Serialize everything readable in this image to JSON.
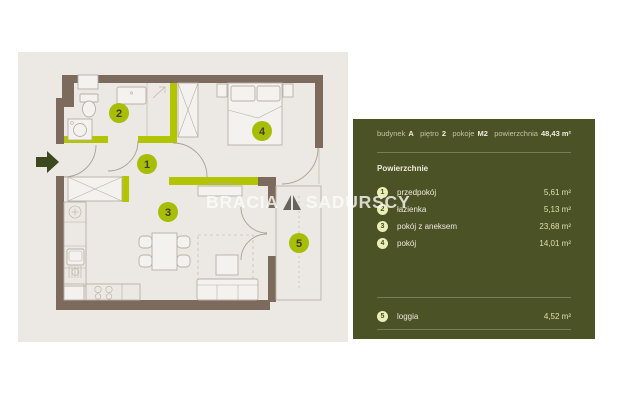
{
  "watermark": {
    "brand_left": "BRACIA",
    "brand_right": "SADURSCY"
  },
  "floorplan": {
    "markers": [
      {
        "num": "1"
      },
      {
        "num": "2"
      },
      {
        "num": "3"
      },
      {
        "num": "4"
      },
      {
        "num": "5"
      }
    ]
  },
  "panel": {
    "header": {
      "items": [
        {
          "label": "budynek",
          "value": "A"
        },
        {
          "label": "piętro",
          "value": "2"
        },
        {
          "label": "pokoje",
          "value": "M2"
        },
        {
          "label": "powierzchnia",
          "value": "48,43 m²"
        }
      ]
    },
    "section_title": "Powierzchnie",
    "rooms": [
      {
        "num": "1",
        "name": "przedpokój",
        "area": "5,61 m²"
      },
      {
        "num": "2",
        "name": "łazienka",
        "area": "5,13 m²"
      },
      {
        "num": "3",
        "name": "pokój z aneksem",
        "area": "23,68 m²"
      },
      {
        "num": "4",
        "name": "pokój",
        "area": "14,01 m²"
      }
    ],
    "extra_rooms": [
      {
        "num": "5",
        "name": "loggia",
        "area": "4,52 m²"
      }
    ]
  },
  "colors": {
    "panel_bg": "#4a5226",
    "plan_bg": "#ece9e4",
    "wall_brown": "#7c6b5d",
    "accent_green": "#b2c500",
    "marker_fill": "#a8bd05",
    "list_circle_bg": "#ebeeb6"
  }
}
